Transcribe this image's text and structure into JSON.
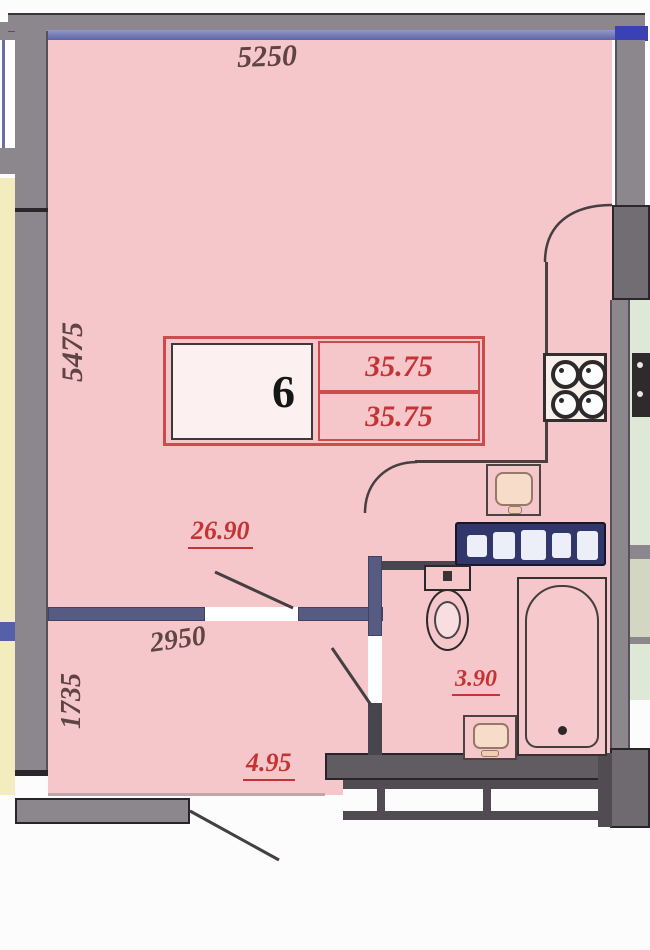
{
  "plan_title": "apartment-floor-plan",
  "room_label": {
    "number": "6",
    "area_top": "35.75",
    "area_bottom": "35.75"
  },
  "dimensions": {
    "top_width": "5250",
    "left_height": "5475",
    "hall_width": "2950",
    "hall_height": "1735"
  },
  "areas": {
    "living_room": "26.90",
    "hallway": "4.95",
    "bathroom": "3.90"
  },
  "colors": {
    "floor_pink": "#f5c6ca",
    "wall_grey": "#8b878d",
    "interior_wall_navy": "#575b82",
    "area_red": "#c53434",
    "dimension_maroon": "#5f4444",
    "adjacent_yellow": "#f2ecbe",
    "adjacent_green": "#dde9d6",
    "vanity_navy": "#31376b",
    "window_blue": "#3a41b5"
  }
}
